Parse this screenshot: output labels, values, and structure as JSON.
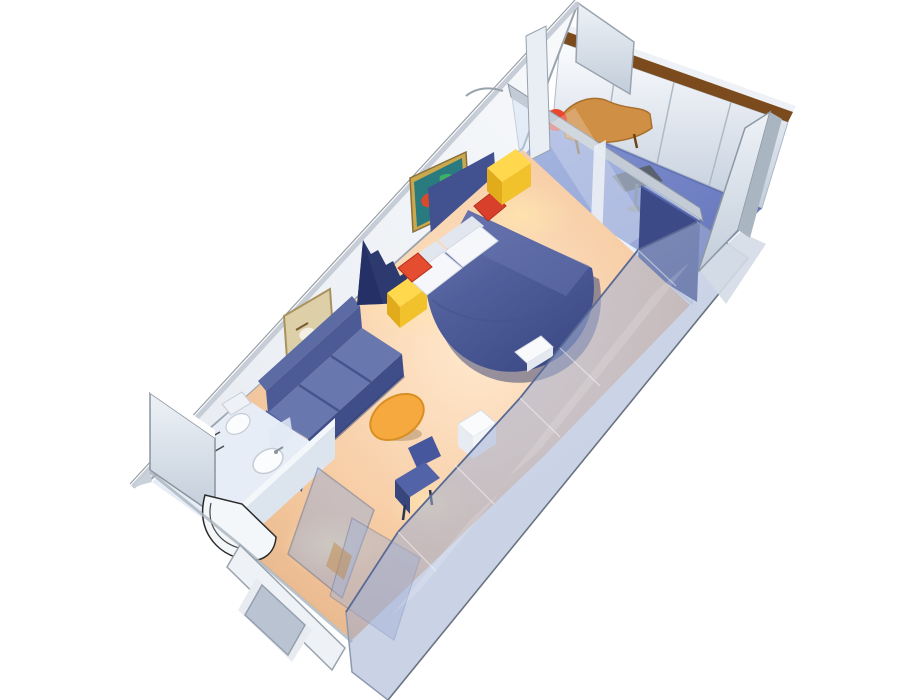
{
  "scene": {
    "description": "3D cutaway rendering of a cruise ship balcony stateroom, viewed from above at a rotated angle on a white background",
    "view": "isometric cutaway, long axis running lower-left (entry/bathroom) to upper-right (private balcony)",
    "background": "#ffffff"
  },
  "rooms": {
    "cabin": {
      "label": "main cabin",
      "elements": [
        "queen-bed",
        "white-pillows",
        "red-accent-cushions",
        "yellow-nightstand-left",
        "yellow-nightstand-right",
        "navy-curtain",
        "blue-sofa",
        "reef-artwork",
        "beige-artwork",
        "orange-ottoman",
        "vanity-chair",
        "vanity-table",
        "white-bench",
        "peach-carpet"
      ]
    },
    "bathroom": {
      "label": "bathroom",
      "elements": [
        "curved-shower",
        "washbasin",
        "toilet",
        "towel-bars",
        "mirror"
      ]
    },
    "entry": {
      "label": "entry hallway",
      "elements": [
        "entry-door",
        "wardrobe-panels",
        "corridor-wall"
      ]
    },
    "balcony": {
      "label": "private balcony",
      "elements": [
        "sliding-glass-door",
        "balcony-lounge-chair",
        "red-lamp",
        "balcony-side-table",
        "railing-with-wood-cap",
        "left-partition",
        "right-partition",
        "blue-balcony-floor"
      ]
    }
  },
  "palette": {
    "background": "#ffffff",
    "wall_face": "#f7f9fb",
    "wall_face_shade": "#e7ebf1",
    "wall_edge_band": "#c6cdd6",
    "outline_gray": "#9aa4ae",
    "outline_dark": "#6b7480",
    "headboard_navy": "#42518f",
    "curtain_navy": "#2c3a70",
    "curtain_dark": "#243064",
    "carpet_light": "#ffe8cd",
    "carpet_mid": "#f6cba2",
    "carpet_dark": "#e2ae82",
    "glow_warm": "#ffe3ae",
    "bed_light": "#6b78b2",
    "bed_mid": "#515f9c",
    "bed_dark": "#3c4a86",
    "bed_shadow": "#2f3c72",
    "pillow_white": "#f6f7fa",
    "pillow_shade": "#e2e6ee",
    "cushion_red": "#d9402c",
    "cushion_red2": "#e44d30",
    "nightstand_top": "#ffd84d",
    "nightstand_left": "#e2ab1c",
    "nightstand_right": "#f2c22c",
    "sofa_top": "#5c6ba4",
    "sofa_back_face": "#4c5a96",
    "sofa_seat": "#6877ae",
    "sofa_front": "#3f4d88",
    "sofa_line": "#46548e",
    "sofa_arm": "#5060a0",
    "ottoman_orange": "#f5a93f",
    "ottoman_dark": "#d98f22",
    "chair_seat": "#5363a8",
    "chair_back": "#47579e",
    "chair_side": "#37477e",
    "bench_white": "#f8fafc",
    "glass_fill": "#cfddf4",
    "glass_frame": "#e9eef4",
    "rail_gray": "#c3ccd6",
    "navy_panel": "#3c4a88",
    "balcony_floor_light": "#8494d2",
    "balcony_floor_dark": "#6172b8",
    "railing_wood": "#7c4b1d",
    "railing_panel_top": "#fbfcfe",
    "railing_panel_bottom": "#c3cedd",
    "partition_light": "#eef2f7",
    "partition_dark": "#c2cdda",
    "chaise_tan": "#cf8f45",
    "chaise_dark": "#a8702f",
    "lamp_red": "#e8472e",
    "table_dark": "#5a6270",
    "bath_floor": "#e6edf6",
    "bath_wall": "#dce4ee",
    "bath_wall_top": "#f4f7fa",
    "fixture_white": "#fbfcfe",
    "fixture_line": "#c6ccd6",
    "shower_line": "#2a2a2a",
    "trans_wall_light": "#b3c0e0",
    "trans_wall_dark": "#8fa0c8",
    "trans_edge": "#5a6a94",
    "trans_outer": "#8d99b0",
    "closet_panel": "#9db0d8",
    "entry_door_glass": "#aab6c8",
    "corridor_wall": "#eef2f6",
    "art1_frame": "#caa84e",
    "art1_bg": "#2a7b80",
    "art1_red": "#d84a2a",
    "art1_green": "#3fae66",
    "art2_bg": "#ddcfa8",
    "art2_frame": "#a8925e",
    "art2_marks": "#7a5a34"
  }
}
